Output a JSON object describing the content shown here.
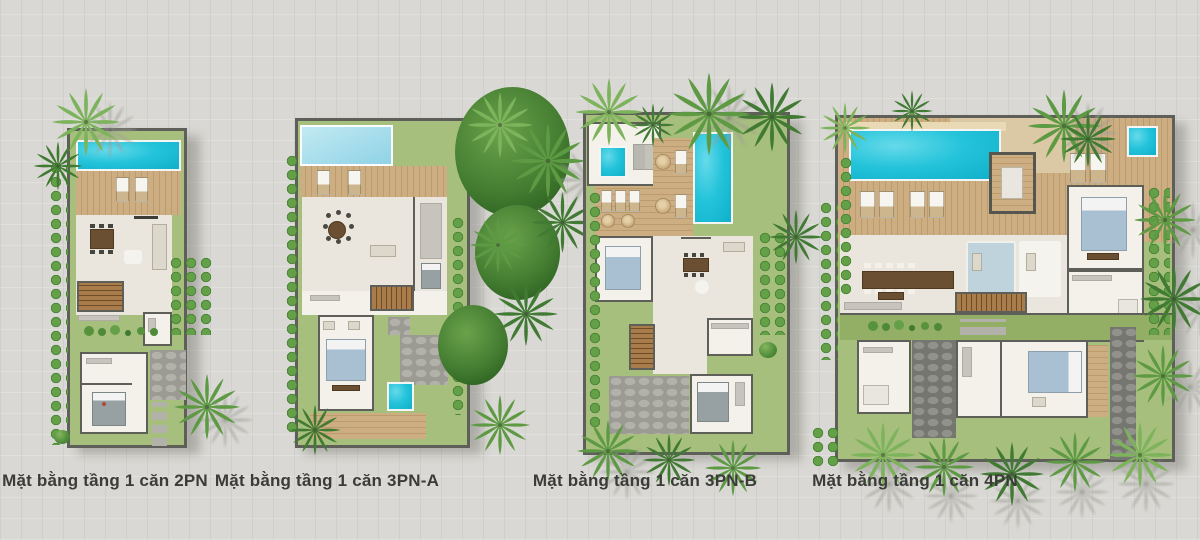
{
  "plans": [
    {
      "id": "2PN",
      "caption": "Mặt bằng tầng 1 căn 2PN"
    },
    {
      "id": "3PN-A",
      "caption": "Mặt bằng tầng 1 căn 3PN-A"
    },
    {
      "id": "3PN-B",
      "caption": "Mặt bằng tầng 1 căn 3PN-B"
    },
    {
      "id": "4PN",
      "caption": "Mặt bằng tầng 1 căn 4PN"
    }
  ],
  "palette": {
    "bg": "#d9d8d4",
    "wall": "#5e5f58",
    "floor": "#eae6dd",
    "floor-light": "#f3f1ea",
    "deck": "#ccae82",
    "deck-dark": "#bc9b6c",
    "sand": "#dbc8a5",
    "lawn": "#a7bf7d",
    "lawn-dark": "#93af66",
    "pool": "#23c3da",
    "pool-deep": "#10afca",
    "pool-pale": "#8fd3e6",
    "pool-pale2": "#c2e9f2",
    "stone": "#9b9b93",
    "stone-blob": "#b2b2aa",
    "stone-dark": "#75766f",
    "stone-dark-blob": "#91928b",
    "wood": "#a87c4b",
    "wood-dark": "#6f4c26",
    "bed-blue": "#a9c0d3",
    "bed-gray": "#97a0a2",
    "palm-green": "#5d9a43",
    "palm-dark": "#417a33",
    "palm-light": "#7cb35b",
    "hedge-light": "#63a047",
    "hedge-dark": "#3f7a2e",
    "caption": "#3b3b39",
    "shadow": "rgba(114,112,104,0.42)"
  }
}
